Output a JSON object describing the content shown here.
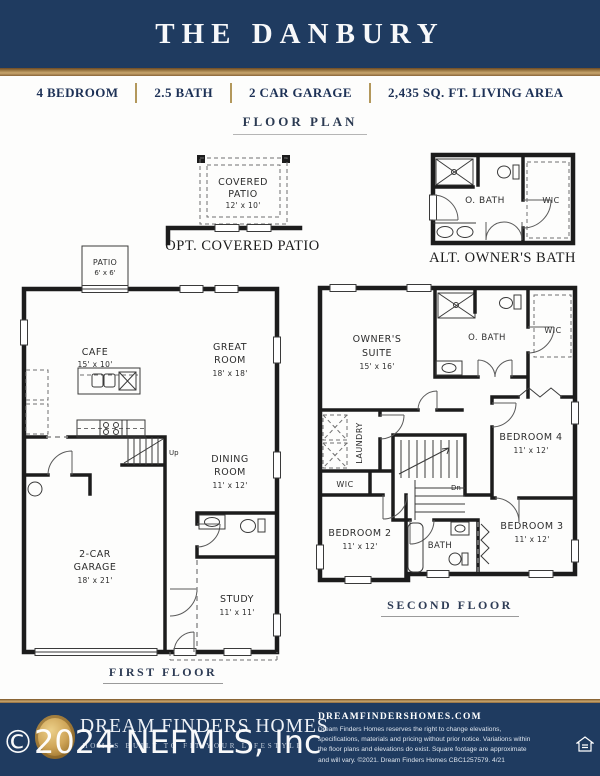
{
  "header": {
    "title": "THE DANBURY"
  },
  "specs": {
    "items": [
      "4 BEDROOM",
      "2.5 BATH",
      "2 CAR GARAGE",
      "2,435 SQ. FT. LIVING AREA"
    ]
  },
  "floor_plan_heading": "FLOOR PLAN",
  "opt_patio": {
    "caption": "OPT. COVERED PATIO",
    "line1": "COVERED",
    "line2": "PATIO",
    "dims": "12' x 10'"
  },
  "alt_bath": {
    "caption": "ALT. OWNER'S BATH",
    "obath": "O. BATH",
    "wic": "WIC"
  },
  "first_floor": {
    "caption": "FIRST FLOOR",
    "patio": "PATIO",
    "patio_dims": "6' x 6'",
    "cafe": "CAFE",
    "cafe_dims": "15' x 10'",
    "great1": "GREAT",
    "great2": "ROOM",
    "great_dims": "18' x 18'",
    "dining1": "DINING",
    "dining2": "ROOM",
    "dining_dims": "11' x 12'",
    "garage1": "2-CAR",
    "garage2": "GARAGE",
    "garage_dims": "18' x 21'",
    "study": "STUDY",
    "study_dims": "11' x 11'",
    "up": "Up"
  },
  "second_floor": {
    "caption": "SECOND FLOOR",
    "owners1": "OWNER'S",
    "owners2": "SUITE",
    "owners_dims": "15' x 16'",
    "obath": "O. BATH",
    "wic_top": "WIC",
    "laundry": "LAUNDRY",
    "wic_small": "WIC",
    "dn": "Dn",
    "bedroom4": "BEDROOM 4",
    "bedroom4_dims": "11' x 12'",
    "bedroom2": "BEDROOM 2",
    "bedroom2_dims": "11' x 12'",
    "bath": "BATH",
    "bedroom3": "BEDROOM 3",
    "bedroom3_dims": "11' x 12'"
  },
  "footer": {
    "brand": "DREAM FINDERS HOMES",
    "tagline": "HOMES BUILT TO FIT YOUR LIFESTYLE",
    "website": "DREAMFINDERSHOMES.COM",
    "disclaimer": "Dream Finders Homes reserves the right to change elevations, specifications, materials and pricing without prior notice. Variations within the floor plans and elevations do exist. Square footage are approximate and will vary. ©2021. Dream Finders Homes CBC1257579.  4/21"
  },
  "watermark": "©2024 NEFMLS, Inc",
  "colors": {
    "navy": "#1f3b60",
    "gold": "#b3985c",
    "wall": "#1c1c1c"
  }
}
